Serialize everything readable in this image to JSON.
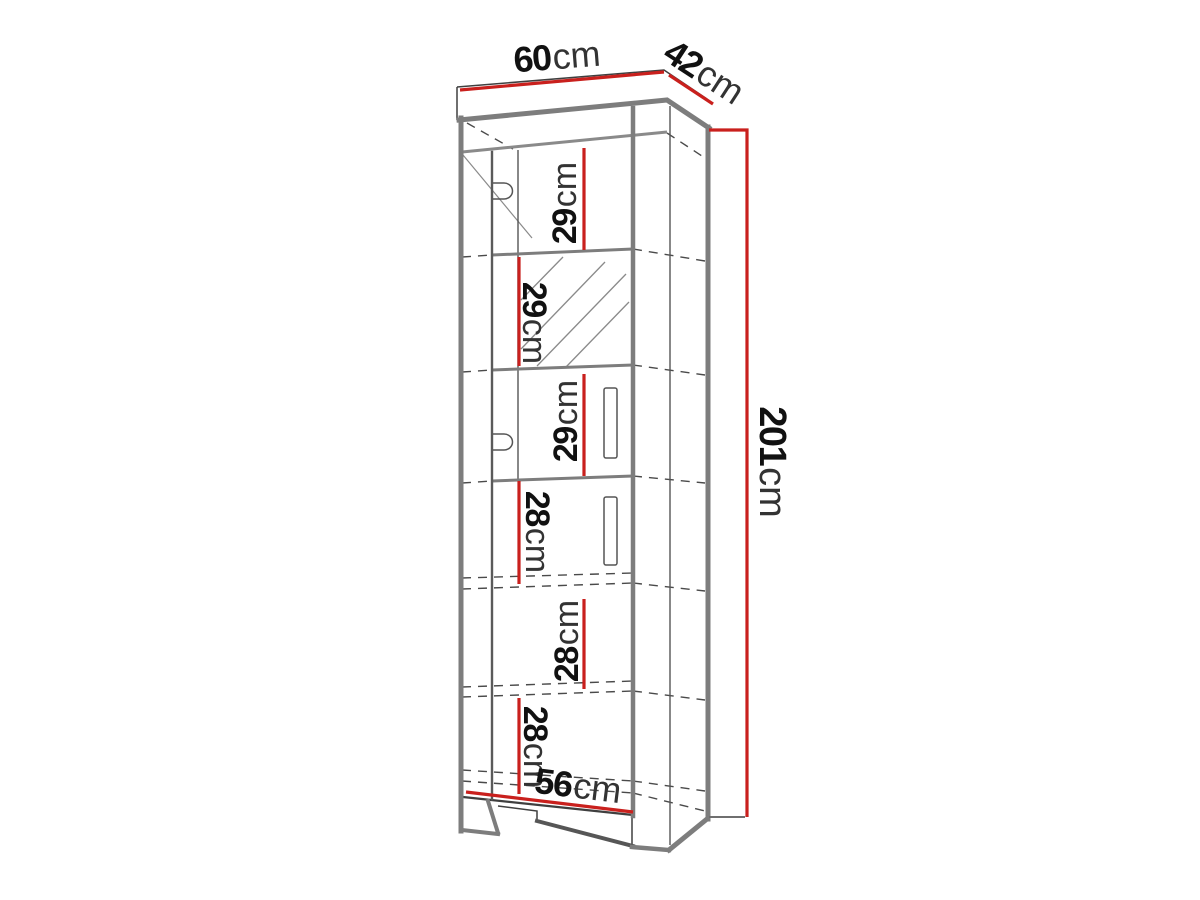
{
  "figure": {
    "background": "#ffffff"
  },
  "colors": {
    "dimension_red": "#c9201d",
    "outline_gray": "#7d7d7d",
    "line_dark": "#3f3f3f",
    "label_text": "#141414"
  },
  "dimensions": {
    "top_width": {
      "value": "60",
      "unit": "cm"
    },
    "top_depth": {
      "value": "42",
      "unit": "cm"
    },
    "overall_height": {
      "value": "201",
      "unit": "cm"
    },
    "bottom_width": {
      "value": "56",
      "unit": "cm"
    },
    "sections_top_to_bottom": [
      {
        "value": "29",
        "unit": "cm"
      },
      {
        "value": "29",
        "unit": "cm"
      },
      {
        "value": "29",
        "unit": "cm"
      },
      {
        "value": "28",
        "unit": "cm"
      },
      {
        "value": "28",
        "unit": "cm"
      },
      {
        "value": "28",
        "unit": "cm"
      }
    ]
  }
}
